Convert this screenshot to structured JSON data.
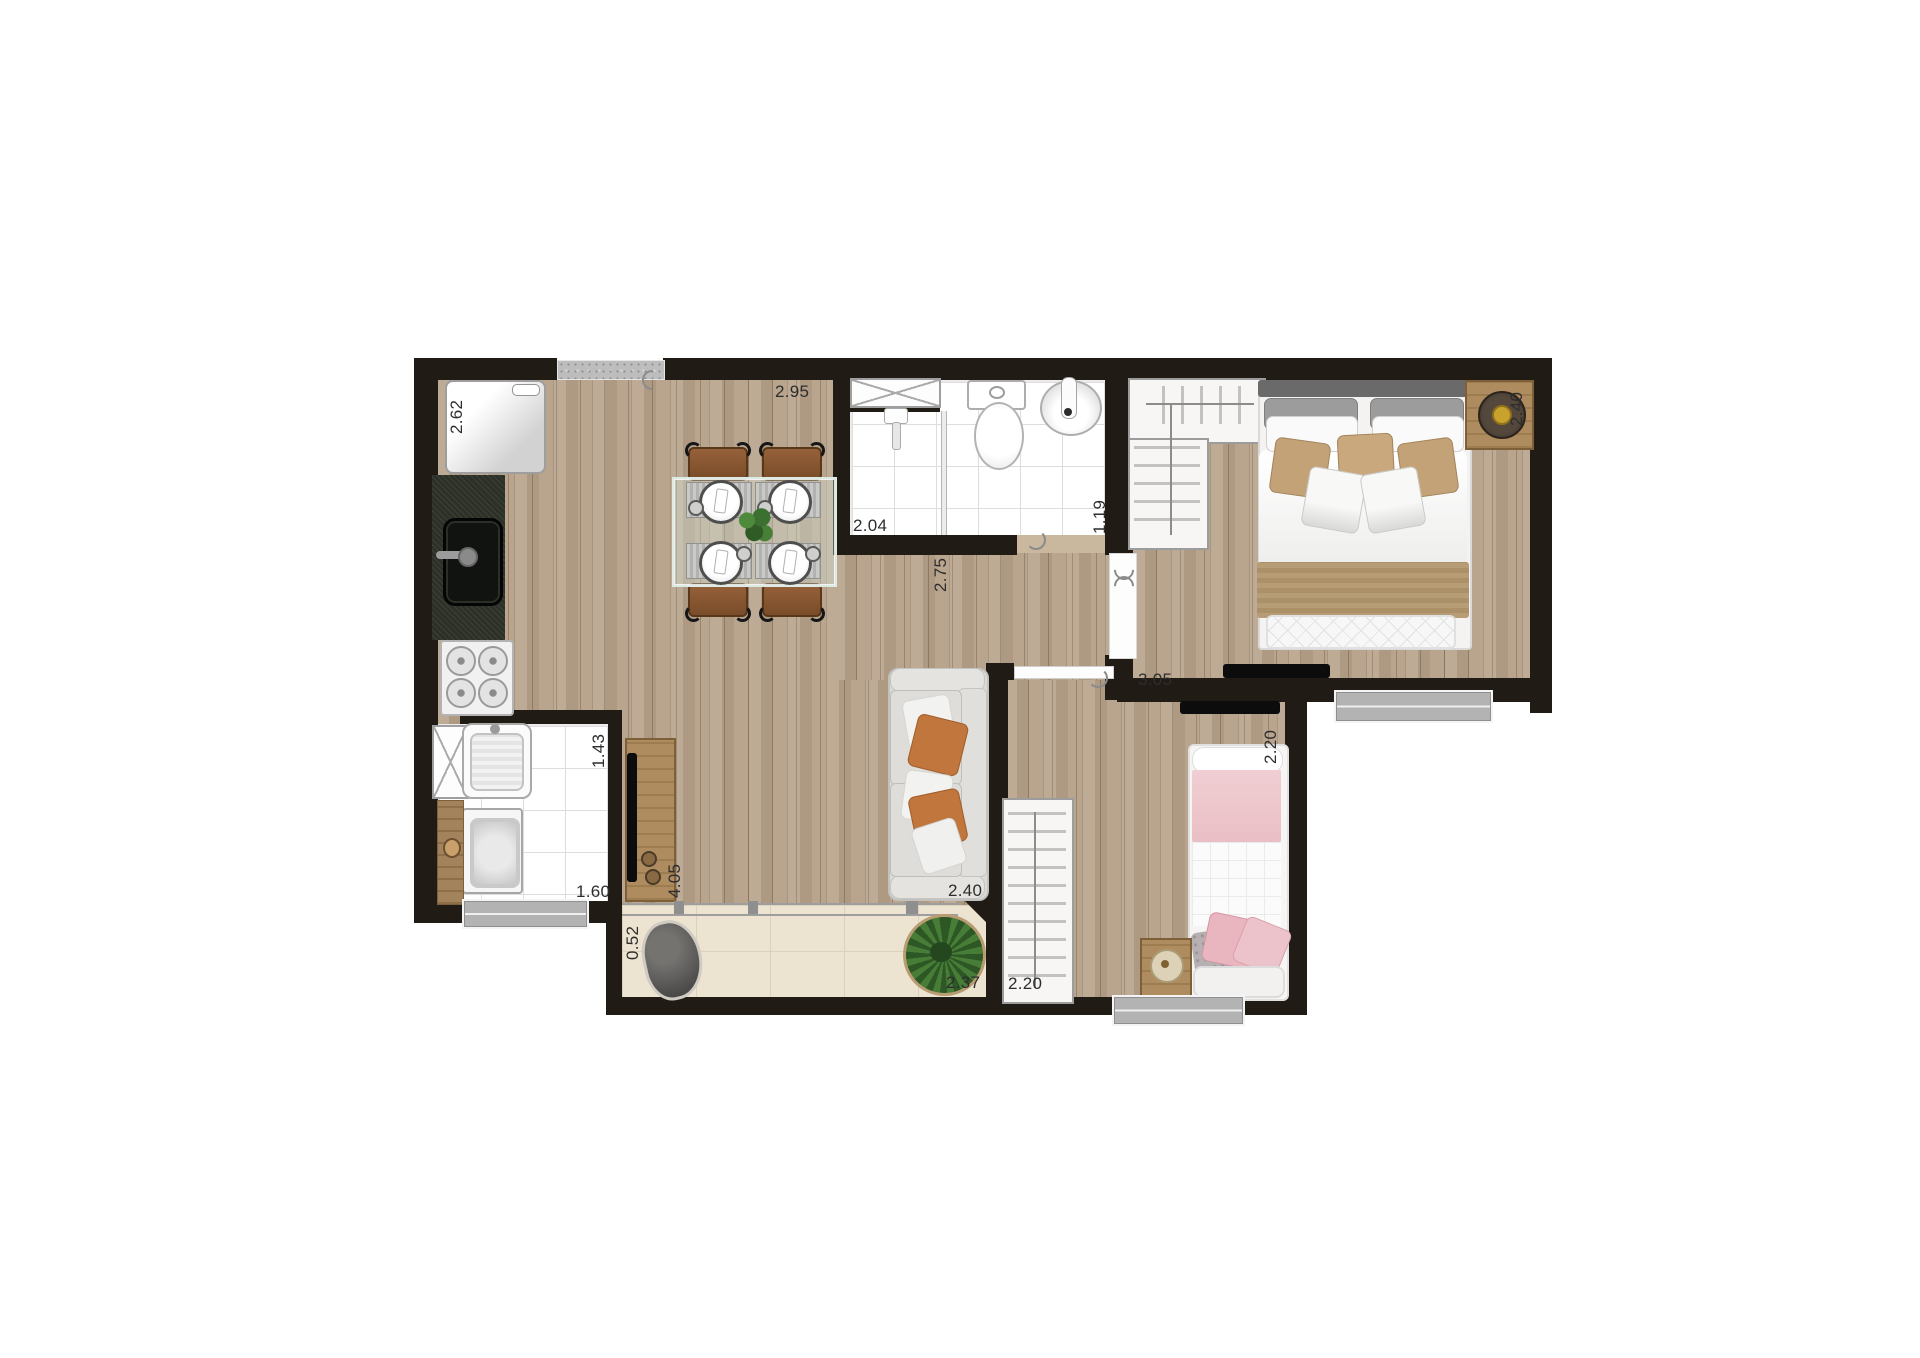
{
  "plan": {
    "dims": {
      "fridge": "2.62",
      "dining": "2.95",
      "shower": "2.04",
      "bath": "1.19",
      "hall": "2.75",
      "bedroom1_w": "2.40",
      "bedroom1_l": "3.05",
      "laundry_l": "1.43",
      "laundry_w": "1.60",
      "living_l": "4.05",
      "living_w": "2.40",
      "balcony_d": "0.52",
      "balcony_w": "2.37",
      "bedroom2_l": "2.20",
      "bedroom2_w": "2.20"
    },
    "colors": {
      "wall": "#211b16",
      "wood_floor": "#b7a28a",
      "tile": "#ffffff",
      "balcony_floor": "#ece4d1",
      "accent_pillow": "#c0763c",
      "blanket_pink": "#ecc6cb",
      "granite_counter": "#2c3028"
    }
  }
}
